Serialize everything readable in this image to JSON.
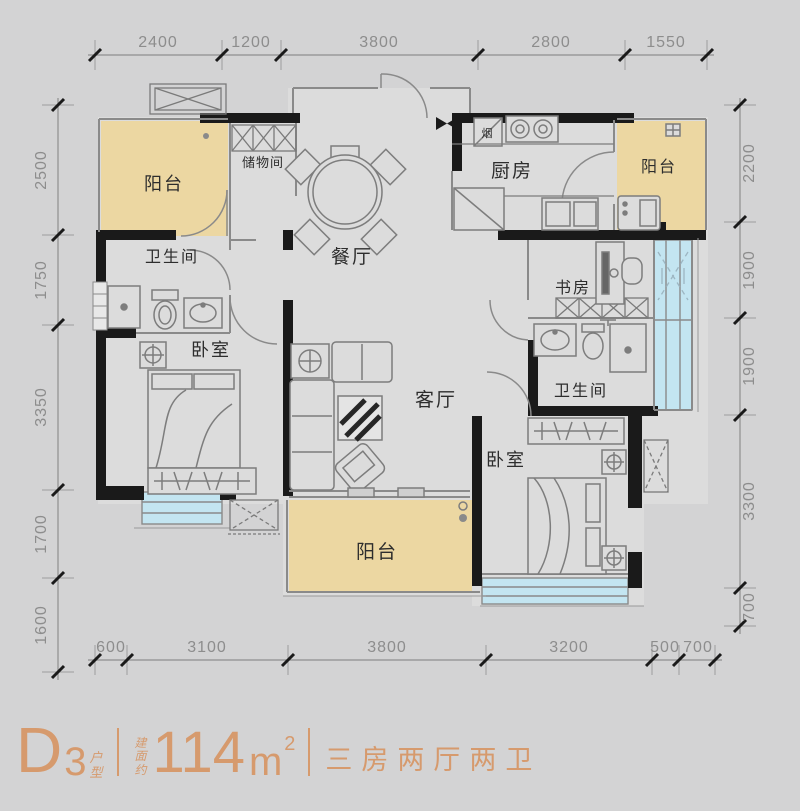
{
  "page": {
    "background": "#d3d3d4"
  },
  "plan": {
    "rooms": {
      "balcony_top_left": "阳台",
      "storage": "储物间",
      "dining": "餐厅",
      "kitchen": "厨房",
      "balcony_top_right": "阳台",
      "flue": "烟",
      "bath_left": "卫生间",
      "bedroom_left": "卧室",
      "living": "客厅",
      "study": "书房",
      "bath_right": "卫生间",
      "bedroom_right": "卧室",
      "balcony_bottom": "阳台"
    },
    "colors": {
      "wall": "#1a1a1a",
      "floor": "#dcdcdc",
      "balcony_fill": "#ecd7a2",
      "window_fill": "#c3e5f1",
      "line": "#8a8a8a",
      "dimension_text": "#8d8d8d"
    }
  },
  "dims": {
    "top": [
      "2400",
      "1200",
      "3800",
      "2800",
      "1550"
    ],
    "left": [
      "2500",
      "1750",
      "3350",
      "1700",
      "1600"
    ],
    "right": [
      "2200",
      "1900",
      "1900",
      "3300",
      "700"
    ],
    "bottom": [
      "600",
      "3100",
      "3800",
      "3200",
      "500",
      "700"
    ]
  },
  "title": {
    "model_letter": "D",
    "model_number": "3",
    "model_suffix": [
      "户",
      "型"
    ],
    "area_label": [
      "建",
      "面",
      "约"
    ],
    "area_value": "114",
    "area_unit": "m",
    "area_exponent": "2",
    "tagline": "三房两厅两卫",
    "accent": "#d69a6d"
  }
}
